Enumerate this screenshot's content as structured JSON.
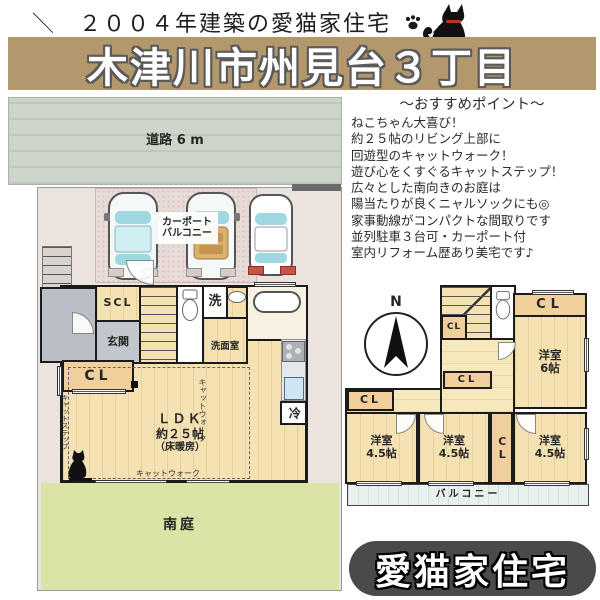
{
  "colors": {
    "banner": "#b2986c",
    "badge_bg": "#4a4a4a",
    "floor_tan": "#f4e2b2",
    "closet_tan": "#f0cf9c",
    "garden_green": "#dbe3a7",
    "road_gray": "#cdd5c9",
    "balcony_blue": "#e9f1ef",
    "entrance_gray": "#c2c6cd",
    "wall_black": "#1b1b1b"
  },
  "header": {
    "slash_open": "＼",
    "tagline": "２００４年建築の愛猫家住宅",
    "slash_close": "／",
    "title": "木津川市州見台３丁目"
  },
  "points": {
    "heading": "〜おすすめポイント〜",
    "lines": [
      "ねこちゃん大喜び！",
      "約２５帖のリビング上部に",
      "回遊型のキャットウォーク！",
      "遊び心をくすぐるキャットステップ！",
      "広々とした南向きのお庭は",
      "陽当たりが良くニャルソックにも◎",
      "家事動線がコンパクトな間取りです",
      "並列駐車３台可・カーポート付",
      "室内リフォーム歴あり美宅です♪"
    ]
  },
  "floor1": {
    "road": "道路 6 m",
    "carport": [
      "カーポート",
      "バルコニー"
    ],
    "scl": "SCL",
    "genkan": "玄関",
    "cl": "CL",
    "washer": "洗",
    "washroom": "洗面室",
    "ldk": [
      "ＬＤＫ",
      "約２５帖",
      "（床暖房）"
    ],
    "fridge": "冷",
    "catwalk_side": "キャットウォーク",
    "catwalk_bottom": "キャットウォーク",
    "catstep": "キャットステップ",
    "garden": "南庭"
  },
  "floor2": {
    "north": "N",
    "cl_stair": "CL",
    "cl_top": "CL",
    "cl_hall": "CL",
    "cl_left": "CL",
    "cl_mid": "CL",
    "room6": [
      "洋室",
      "6帖"
    ],
    "room45_1": [
      "洋室",
      "4.5帖"
    ],
    "room45_2": [
      "洋室",
      "4.5帖"
    ],
    "room45_3": [
      "洋室",
      "4.5帖"
    ],
    "balcony": "バルコニー"
  },
  "badge": {
    "label": "愛猫家住宅"
  }
}
